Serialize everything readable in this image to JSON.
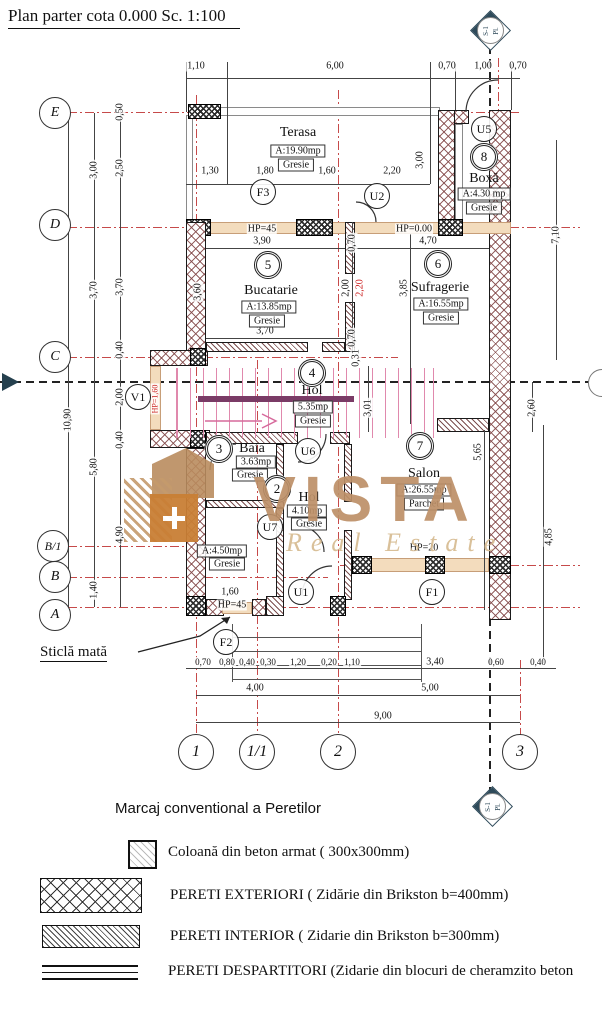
{
  "title": "Plan parter cota  0.000 Sc. 1:100",
  "watermark": {
    "name": "VISTA",
    "tagline": "Real Estate"
  },
  "section": {
    "s": "S-1",
    "pl": "Pl."
  },
  "note": {
    "text": "Sticlă mată"
  },
  "axes": {
    "left": [
      "E",
      "D",
      "C",
      "B/1",
      "B",
      "A"
    ],
    "bottom": [
      "1",
      "1/1",
      "2",
      "3"
    ]
  },
  "rooms": {
    "terasa": {
      "number": "",
      "name": "Terasa",
      "area": "A:19.90mp",
      "floor": "Gresie"
    },
    "boxa": {
      "number": "8",
      "name": "Boxă",
      "area": "A:4.30 mp",
      "floor": "Gresie"
    },
    "bucatarie": {
      "number": "5",
      "name": "Bucatarie",
      "area": "A:13.85mp",
      "floor": "Gresie"
    },
    "sufragerie": {
      "number": "6",
      "name": "Sufragerie",
      "area": "A:16.55mp",
      "floor": "Gresie"
    },
    "hol": {
      "number": "4",
      "name": "Hol",
      "area": "5.35mp",
      "floor": "Gresie"
    },
    "baia": {
      "number": "3",
      "name": "Baia",
      "area": "3.63mp",
      "floor": "Gresie"
    },
    "hol2": {
      "number": "2",
      "name": "Hol",
      "area": "4.10mp",
      "floor": "Gresie"
    },
    "salon": {
      "number": "7",
      "name": "Salon",
      "area": "A:26.55mp",
      "floor": "Parchet"
    },
    "camera1": {
      "number": "",
      "name": "",
      "area": "A:4.50mp",
      "floor": "Gresie"
    }
  },
  "openings": {
    "F1": "F1",
    "F2": "F2",
    "F3": "F3",
    "U1": "U1",
    "U2": "U2",
    "U5": "U5",
    "U6": "U6",
    "U7": "U7",
    "V1": "V1"
  },
  "hp": {
    "bucatarie": "HP=45",
    "sufragerie": "HP=0.00",
    "salon": "HP=20",
    "intrare": "HP=45",
    "v1": "HP=1,60"
  },
  "dims": {
    "top1": [
      "1,10",
      "6,00",
      "0,70",
      "1,00",
      "0,70"
    ],
    "top2": [
      "1,30",
      "1,80",
      "1,60",
      "2,20"
    ],
    "terasa_height": "3,00",
    "right": [
      "7,10",
      "2,60",
      "4,85"
    ],
    "left_total": "10,90",
    "left1": [
      "3,00",
      "3,70",
      "5,80",
      "1,40"
    ],
    "left2": [
      "0,50",
      "2,50",
      "3,70",
      "0,40",
      "2,00",
      "0,40",
      "4,90"
    ],
    "bucatarie": [
      "3,90",
      "3,60",
      "3,70"
    ],
    "mid": [
      "0,70",
      "2,00",
      "2,20",
      "0,70"
    ],
    "sufragerie": [
      "4,70",
      "3,85"
    ],
    "hol": [
      "0,31",
      "3,01"
    ],
    "salon": [
      "5,65"
    ],
    "bottom1": [
      "0,70",
      "0,80",
      "0,40",
      "0,30",
      "1,20",
      "0,20",
      "1,10",
      "3,40",
      "0,60",
      "0,40"
    ],
    "bottom2": [
      "4,00",
      "5,00"
    ],
    "bottom3": [
      "9,00"
    ],
    "door_width": "1,60"
  },
  "legend": {
    "heading": "Marcaj conventional a Peretilor",
    "items": [
      {
        "label": "Coloană din beton armat  ( 300x300mm)"
      },
      {
        "label": "PERETI EXTERIORI ( Zidărie din Brikston b=400mm)"
      },
      {
        "label": "PERETI INTERIOR ( Zidarie din Brikston b=300mm)"
      },
      {
        "label": "PERETI DESPARTITORI (Zidarie din blocuri  de cheramzito beton"
      }
    ]
  }
}
